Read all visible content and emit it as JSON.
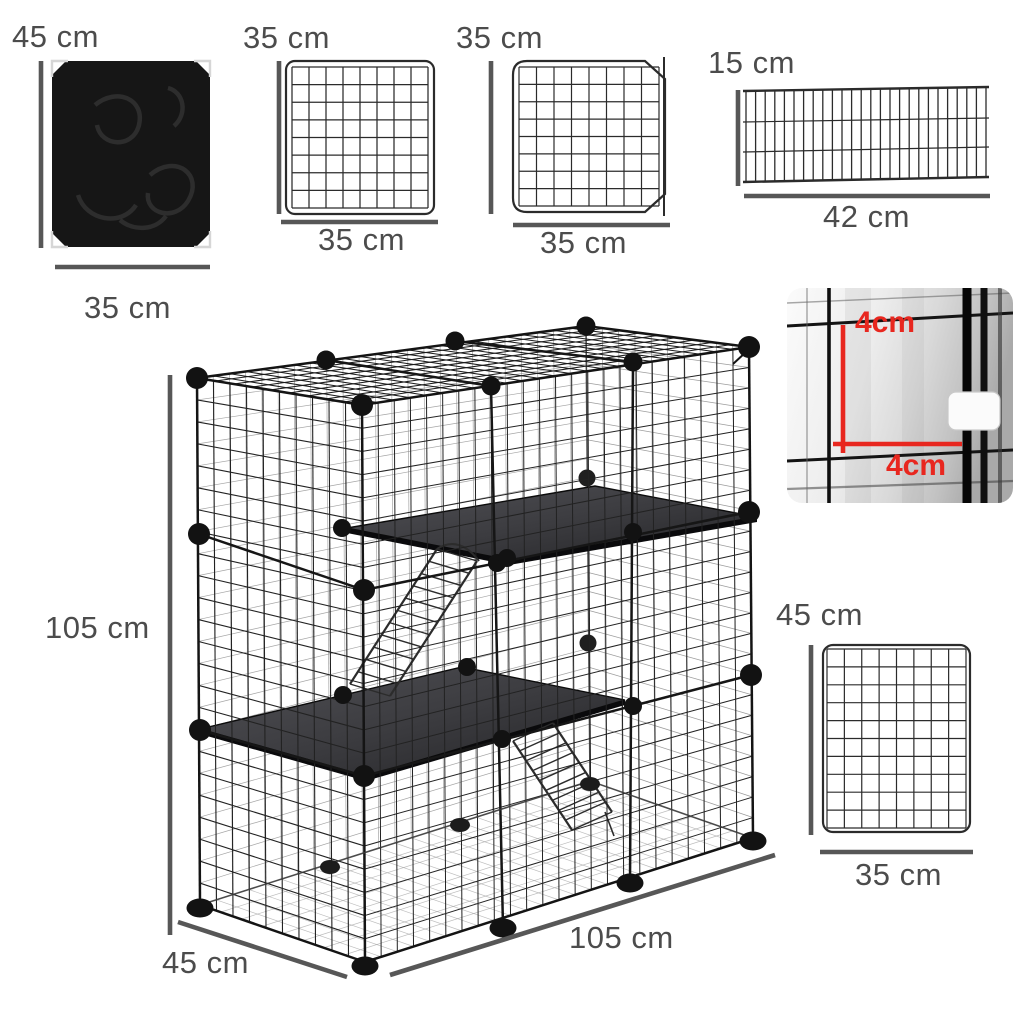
{
  "colors": {
    "accent_red": "#e8271f",
    "wire": "#262626",
    "wire_far": "#8e8e8e",
    "dim_line": "#575757",
    "label_text": "#4c4c4c",
    "shelf_dark": "#3c3c40",
    "fabric_black": "#161616"
  },
  "components": {
    "fabric_panel": {
      "height_label": "45 cm",
      "width_label": "35 cm"
    },
    "grid_panel": {
      "height_label": "35 cm",
      "width_label": "35 cm"
    },
    "door_panel": {
      "height_label": "35 cm",
      "width_label": "35 cm"
    },
    "shelf_ramp_panel": {
      "height_label": "15 cm",
      "width_label": "42 cm"
    },
    "mesh_detail": {
      "vertical_label": "4cm",
      "horizontal_label": "4cm"
    },
    "side_panel": {
      "height_label": "45 cm",
      "width_label": "35 cm"
    },
    "assembled_cage": {
      "height_label": "105 cm",
      "depth_label": "45 cm",
      "width_label": "105 cm"
    }
  }
}
